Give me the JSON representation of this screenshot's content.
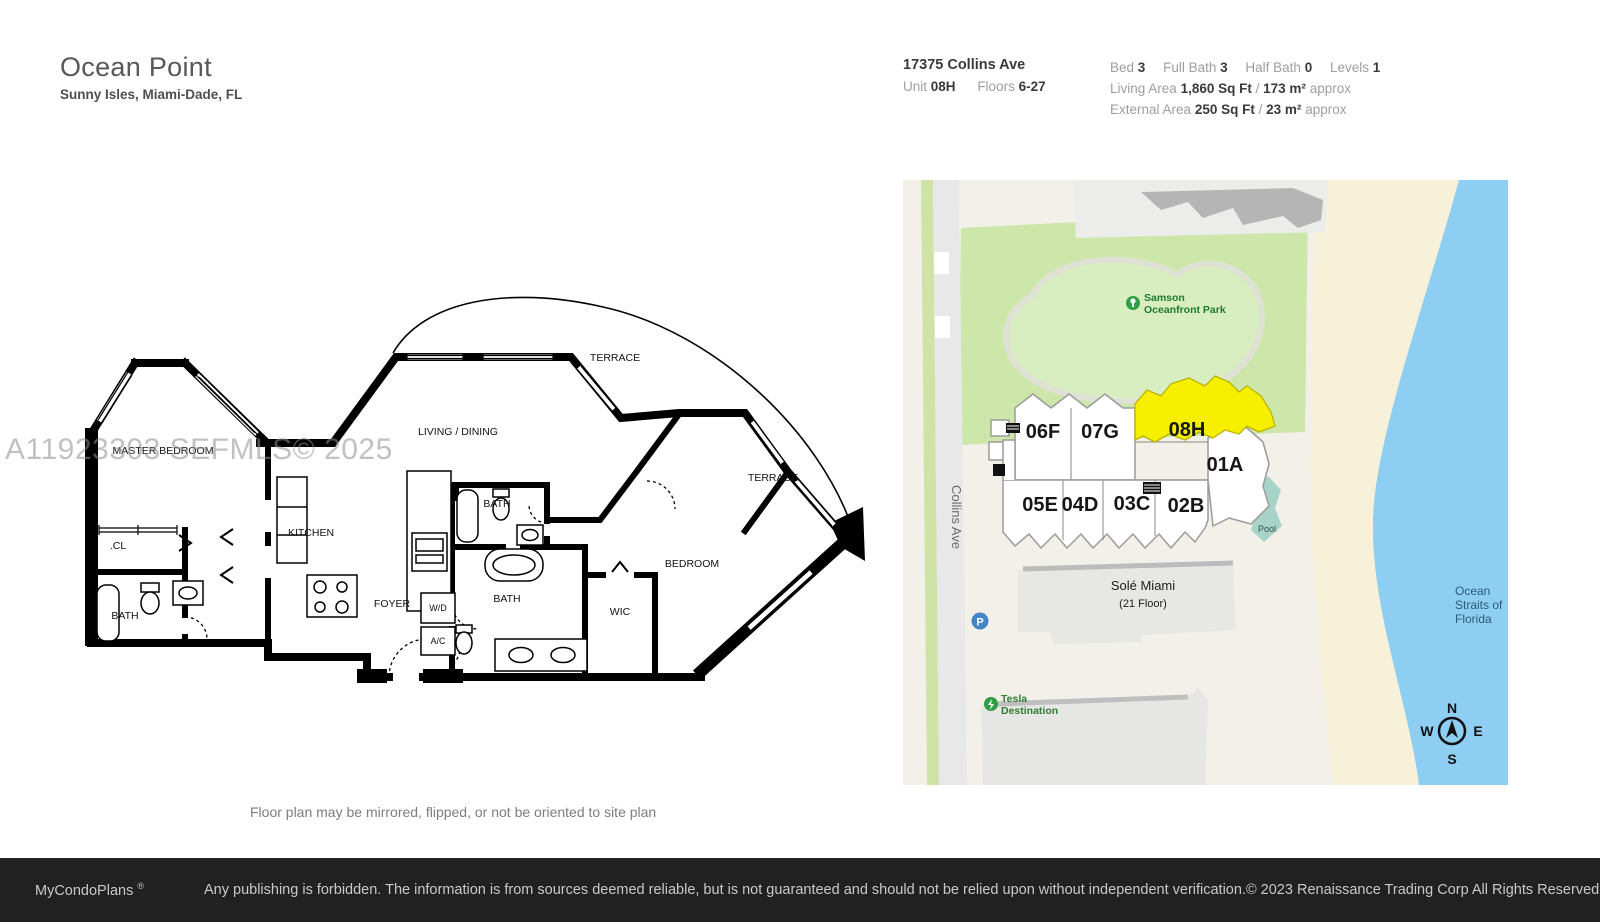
{
  "header": {
    "title": "Ocean Point",
    "subtitle": "Sunny Isles, Miami-Dade, FL",
    "address": "17375 Collins Ave",
    "unit_label": "Unit",
    "unit": "08H",
    "floors_label": "Floors",
    "floors": "6-27",
    "bed_label": "Bed",
    "bed": "3",
    "full_bath_label": "Full Bath",
    "full_bath": "3",
    "half_bath_label": "Half Bath",
    "half_bath": "0",
    "levels_label": "Levels",
    "levels": "1",
    "living_area_label": "Living Area",
    "living_area": "1,860 Sq Ft",
    "living_area_metric": "173 m²",
    "external_area_label": "External Area",
    "external_area": "250 Sq Ft",
    "external_area_metric": "23 m²",
    "slash": "/",
    "approx": "approx"
  },
  "watermark": "A11923303 SEFMLS© 2025",
  "floorplan": {
    "note": "Floor plan may be mirrored, flipped, or not be oriented to site plan",
    "labels": {
      "master_bedroom": "MASTER BEDROOM",
      "terrace_top": "TERRACE",
      "terrace_right": "TERRACE",
      "living_dining": "LIVING / DINING",
      "kitchen": "KITCHEN",
      "closet": ".CL",
      "bath_master": "BATH",
      "bath_upper": "BATH",
      "bath_lower": "BATH",
      "foyer": "FOYER",
      "wd": "W/D",
      "ac": "A/C",
      "wic": "WIC",
      "bedroom": "BEDROOM"
    }
  },
  "map": {
    "street": "Collins Ave",
    "park_line1": "Samson",
    "park_line2": "Oceanfront Park",
    "units": {
      "u06f": "06F",
      "u07g": "07G",
      "u08h": "08H",
      "u01a": "01A",
      "u05e": "05E",
      "u04d": "04D",
      "u03c": "03C",
      "u02b": "02B"
    },
    "highlighted_unit": "08H",
    "pool": "Pool",
    "sole_name": "Solé Miami",
    "sole_floors": "(21 Floor)",
    "parking": "P",
    "tesla_line1": "Tesla",
    "tesla_line2": "Destination",
    "ocean_line1": "Ocean",
    "ocean_line2": "Straits of",
    "ocean_line3": "Florida",
    "compass": {
      "n": "N",
      "e": "E",
      "s": "S",
      "w": "W"
    },
    "colors": {
      "highlight_yellow": "#f6ef00",
      "park_green": "#cde7ab",
      "ocean_blue": "#8fcef3",
      "beach_sand": "#f7f1da",
      "pool_teal": "#a7d3c9"
    }
  },
  "footer": {
    "brand": "MyCondoPlans",
    "reg": "®",
    "disclaimer": "Any publishing is forbidden. The information is from sources deemed reliable, but is not guaranteed and should not be relied upon without independent verification.",
    "copyright": "© 2023 Renaissance Trading Corp  All Rights Reserved"
  }
}
